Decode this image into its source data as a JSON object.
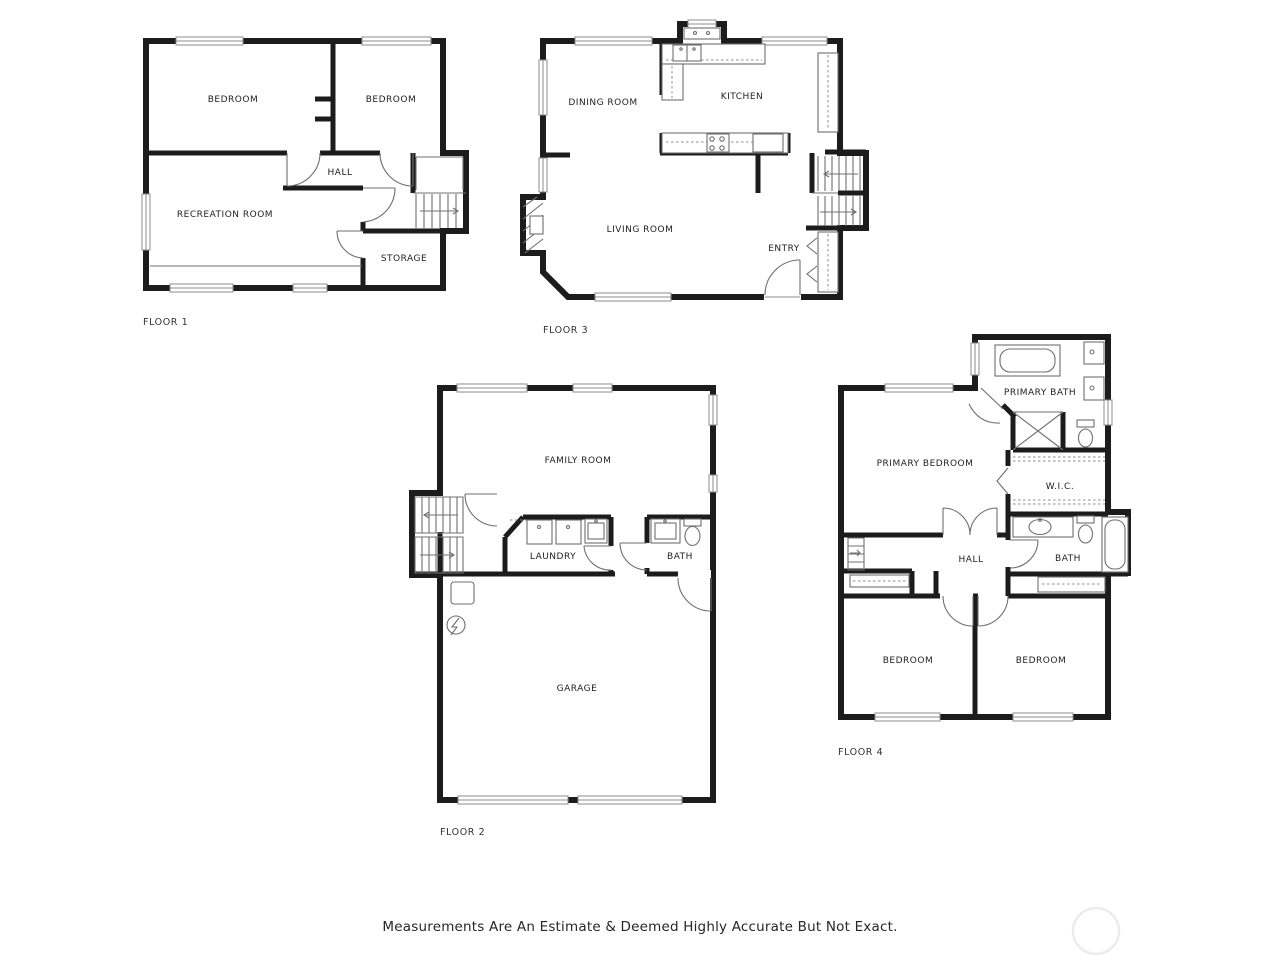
{
  "page": {
    "disclaimer": "Measurements Are An Estimate & Deemed Highly Accurate But Not Exact."
  },
  "floor1": {
    "label": "FLOOR 1",
    "rooms": {
      "bedroom_left": "BEDROOM",
      "bedroom_right": "BEDROOM",
      "hall": "HALL",
      "recreation_room": "RECREATION ROOM",
      "storage": "STORAGE"
    }
  },
  "floor2": {
    "label": "FLOOR 2",
    "rooms": {
      "family_room": "FAMILY ROOM",
      "laundry": "LAUNDRY",
      "bath": "BATH",
      "garage": "GARAGE"
    }
  },
  "floor3": {
    "label": "FLOOR 3",
    "rooms": {
      "dining_room": "DINING ROOM",
      "kitchen": "KITCHEN",
      "living_room": "LIVING ROOM",
      "entry": "ENTRY"
    }
  },
  "floor4": {
    "label": "FLOOR 4",
    "rooms": {
      "primary_bath": "PRIMARY BATH",
      "primary_bedroom": "PRIMARY BEDROOM",
      "wic": "W.I.C.",
      "hall": "HALL",
      "bath": "BATH",
      "bedroom_left": "BEDROOM",
      "bedroom_right": "BEDROOM"
    }
  },
  "colors": {
    "wall": "#1c1c1c",
    "thin_line": "#6f6f6f",
    "window_line": "#8c8c8c",
    "text": "#1f1f1f",
    "background": "#ffffff",
    "watermark": "#ececec"
  }
}
